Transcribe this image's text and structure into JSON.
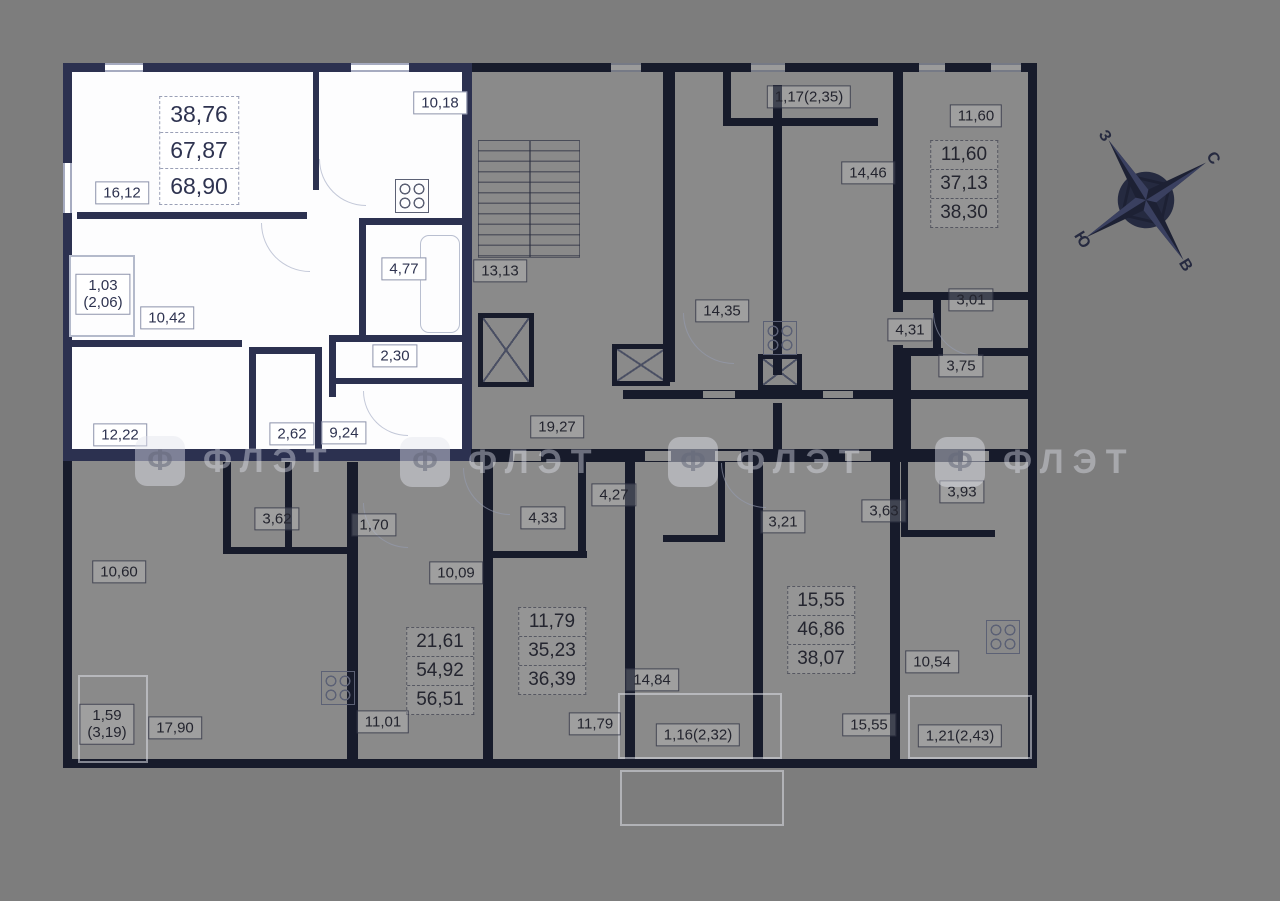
{
  "title": "floor-plan",
  "watermark": {
    "text": "ФЛЭТ",
    "icon_glyph": "Ф"
  },
  "compass": {
    "north": "С",
    "south": "Ю",
    "west": "З",
    "east": "В"
  },
  "colors": {
    "background": "#7d7d7d",
    "plan_fill": "#8a8a8a",
    "wall": "#171b2b",
    "highlight_wall": "#2c3150",
    "highlight_fill": "#fdfdfe",
    "label_text": "#2e3350"
  },
  "areas": {
    "hl_sum_1": "38,76",
    "hl_sum_2": "67,87",
    "hl_sum_3": "68,90",
    "hl_living": "16,12",
    "hl_kitchen": "10,18",
    "hl_bath": "4,77",
    "hl_hall": "10,42",
    "hl_wc": "2,30",
    "hl_bedroom": "12,22",
    "hl_wardrobe": "2,62",
    "hl_entry": "9,24",
    "hl_balcony_1": "1,03",
    "hl_balcony_2": "(2,06)",
    "stairs": "13,13",
    "hall_upper": "14,35",
    "hall_main": "19,27",
    "balc_235": "1,17(2,35)",
    "kit_1446": "14,46",
    "rm_1160": "11,60",
    "sum_1160_1": "11,60",
    "sum_1160_2": "37,13",
    "sum_1160_3": "38,30",
    "rm_301": "3,01",
    "rm_431": "4,31",
    "rm_375": "3,75",
    "rm_362": "3,62",
    "rm_170": "1,70",
    "rm_1060": "10,60",
    "rm_1009": "10,09",
    "sum_5651_1": "21,61",
    "sum_5651_2": "54,92",
    "sum_5651_3": "56,51",
    "rm_1101": "11,01",
    "rm_433": "4,33",
    "rm_427": "4,27",
    "sum_3639_1": "11,79",
    "sum_3639_2": "35,23",
    "sum_3639_3": "36,39",
    "rm_1179": "11,79",
    "rm_1484": "14,84",
    "balc_232": "1,16(2,32)",
    "rm_321": "3,21",
    "rm_363": "3,63",
    "rm_393": "3,93",
    "sum_3807_1": "15,55",
    "sum_3807_2": "46,86",
    "sum_3807_3": "38,07",
    "rm_1555": "15,55",
    "rm_1054": "10,54",
    "balc_243": "1,21(2,43)",
    "rm_1790": "17,90",
    "balc_319_1": "1,59",
    "balc_319_2": "(3,19)"
  }
}
